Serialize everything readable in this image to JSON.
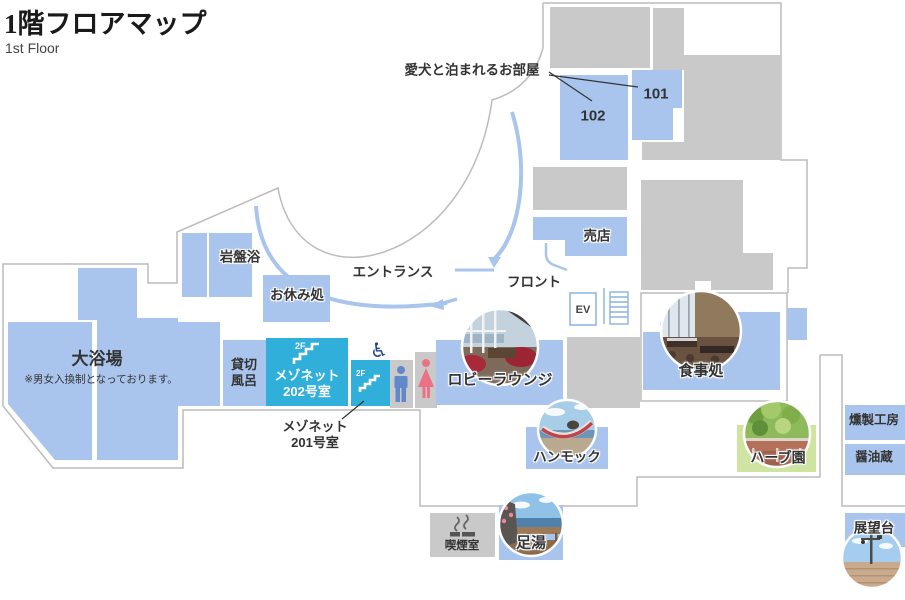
{
  "header": {
    "title": "1階フロアマップ",
    "subtitle": "1st Floor"
  },
  "map": {
    "dog_room_note": "愛犬と泊まれるお部屋",
    "room_102": "102",
    "room_101": "101",
    "shop": "売店",
    "entrance": "エントランス",
    "front_desk": "フロント",
    "ev": "EV",
    "stone_sauna": "岩盤浴",
    "rest_area": "お休み処",
    "large_bath": "大浴場",
    "large_bath_note": "※男女入換制となっております。",
    "private_bath_l1": "貸切",
    "private_bath_l2": "風呂",
    "maisonette202_l1": "メゾネット",
    "maisonette202_l2": "202号室",
    "maisonette201_l1": "メゾネット",
    "maisonette201_l2": "201号室",
    "floor_tag": "2F",
    "lobby_lounge": "ロビーラウンジ",
    "hammock": "ハンモック",
    "dining": "食事処",
    "herb_garden": "ハーブ園",
    "smokehouse": "燻製工房",
    "soy_warehouse": "醤油蔵",
    "smoking_room": "喫煙室",
    "foot_bath": "足湯",
    "observation_deck": "展望台"
  },
  "colors": {
    "room_blue": "#a9c5ed",
    "maisonette_cyan": "#2fafd9",
    "building_gray": "#c9c9c9",
    "herb_green": "#cfe4a0",
    "outline_gray": "#bcbcbc",
    "walk_line_blue": "#a9c5ed",
    "mens_icon": "#6288cc",
    "womens_icon": "#ec7186",
    "wheelchair_icon": "#21418f",
    "ev_blue": "#8ab2e2"
  }
}
